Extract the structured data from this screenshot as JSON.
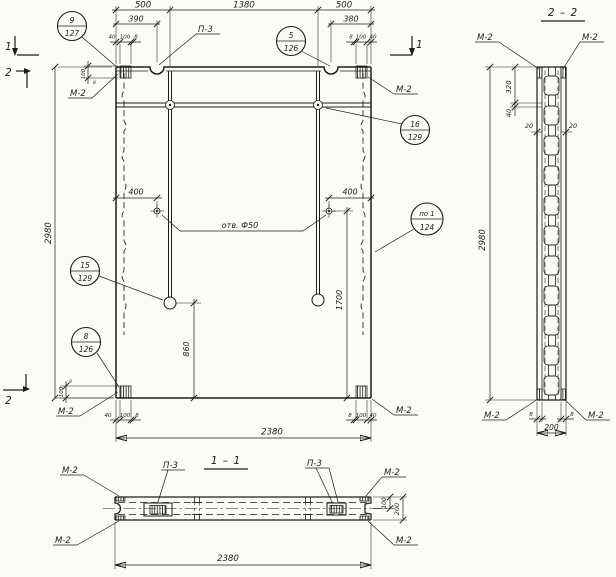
{
  "page": {
    "background": "#fbfbf8",
    "ink": "#1c1c1c"
  },
  "labels": {
    "m2": "М-2",
    "p3": "П-3",
    "hole_note": "отв. Ф50",
    "section1_title": "1 – 1",
    "section2_title": "2 – 2",
    "cut_marker_1": "1",
    "cut_marker_2": "2"
  },
  "balloons": {
    "b9_127": {
      "top": "9",
      "bottom": "127"
    },
    "b5_126": {
      "top": "5",
      "bottom": "126"
    },
    "b16_129": {
      "top": "16",
      "bottom": "129"
    },
    "bpo1_124": {
      "top": "по 1",
      "bottom": "124"
    },
    "b15_129": {
      "top": "15",
      "bottom": "129"
    },
    "b8_126": {
      "top": "8",
      "bottom": "126"
    }
  },
  "dims": {
    "w_edge_500": "500",
    "w_mid_1380": "1380",
    "loop_left_390": "390",
    "loop_right_380": "380",
    "embed_40": "40",
    "embed_100": "100",
    "embed_8": "8",
    "height_2980": "2980",
    "width_2380": "2380",
    "hole_offset_400": "400",
    "rod_right_1700": "1700",
    "rod_left_860": "860",
    "sec2_320": "320",
    "sec2_wall_20": "20",
    "thickness_200": "200"
  }
}
